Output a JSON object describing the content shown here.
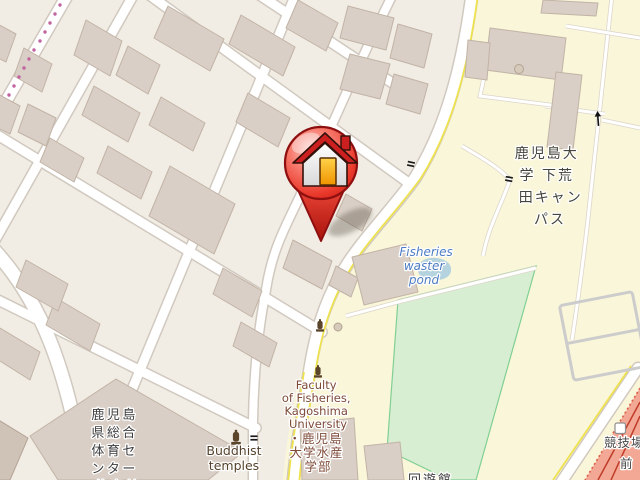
{
  "map": {
    "type": "street-map",
    "labels": {
      "campus": {
        "text": "鹿児島大学 下荒田キャンパス",
        "lines": [
          "鹿児島大",
          "学 下荒",
          "田キャン",
          "パス"
        ]
      },
      "gym": {
        "text": "鹿児島県総合体育センター体育館",
        "lines": [
          "鹿児島",
          "県総合",
          "体育セ",
          "ンター",
          "体育館"
        ]
      },
      "faculty": {
        "text": "Faculty of Fisheries, Kagoshima University ・鹿児島大学水産学部",
        "lines": [
          "Faculty",
          "of Fisheries,",
          "Kagoshima",
          "University",
          "・鹿児島",
          "大学水産",
          "学部"
        ]
      },
      "pond": {
        "text": "Fisheries waster pond",
        "lines": [
          "Fisheries",
          "waster",
          "pond"
        ]
      },
      "buddhist": {
        "text": "Buddhist temples",
        "lines": [
          "Buddhist",
          "temples"
        ]
      },
      "stadium": {
        "text": "競技場前",
        "lines": [
          "競技場",
          "前"
        ]
      },
      "partial_bottom": {
        "text": "回遊館",
        "lines": [
          "回遊館"
        ]
      }
    },
    "icons": {
      "marker": "red-house-pin",
      "monument": "brown-monument",
      "gate": "gate-bars",
      "oneway": "oneway-arrow",
      "tram_stop": "white-square-stop",
      "tram_dots": "pink-tram-dots",
      "tree": "gray-circle-tree"
    },
    "colors": {
      "background": "#f1ede5",
      "campus": "#faf6da",
      "building": "#d9cfc6",
      "road": "#ffffff",
      "road_casing": "#d1c9bf",
      "field_green": "#d8eed2",
      "pond_blue": "#b5d3de",
      "stadium_pink": "#f3a795",
      "road_edge_yellow": "#eee24f",
      "marker_red": "#e23b2e",
      "pond_text_blue": "#4d7cc3",
      "poi_brown": "#7d4a38"
    }
  }
}
